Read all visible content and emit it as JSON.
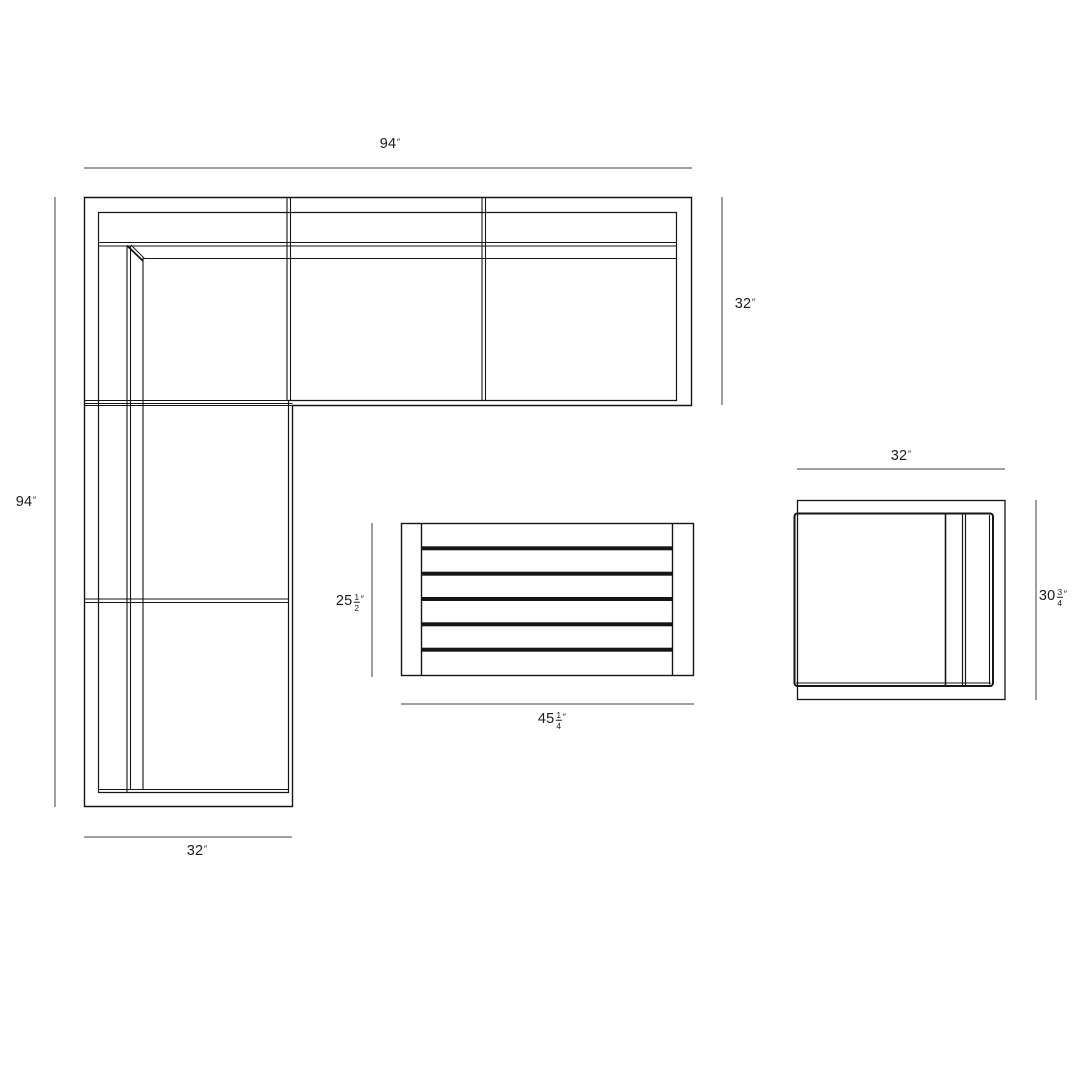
{
  "drawing": {
    "type": "furniture-plan-dimension-drawing",
    "pieces": [
      "sectional-sofa",
      "coffee-table",
      "lounge-chair"
    ],
    "line_color": "#161616",
    "dimension_line_color": "#3f3f3f",
    "background_color": "#ffffff"
  },
  "labels": {
    "sofa_width": {
      "value": "94",
      "unit": "″"
    },
    "sofa_depth": {
      "value": "32",
      "unit": "″"
    },
    "sofa_length": {
      "value": "94",
      "unit": "″"
    },
    "chaise_width": {
      "value": "32",
      "unit": "″"
    },
    "table_depth": {
      "whole": "25",
      "numerator": "1",
      "denominator": "2",
      "unit": "″"
    },
    "table_width": {
      "whole": "45",
      "numerator": "1",
      "denominator": "4",
      "unit": "″"
    },
    "chair_width": {
      "value": "32",
      "unit": "″"
    },
    "chair_depth": {
      "whole": "30",
      "numerator": "3",
      "denominator": "4",
      "unit": "″"
    }
  }
}
